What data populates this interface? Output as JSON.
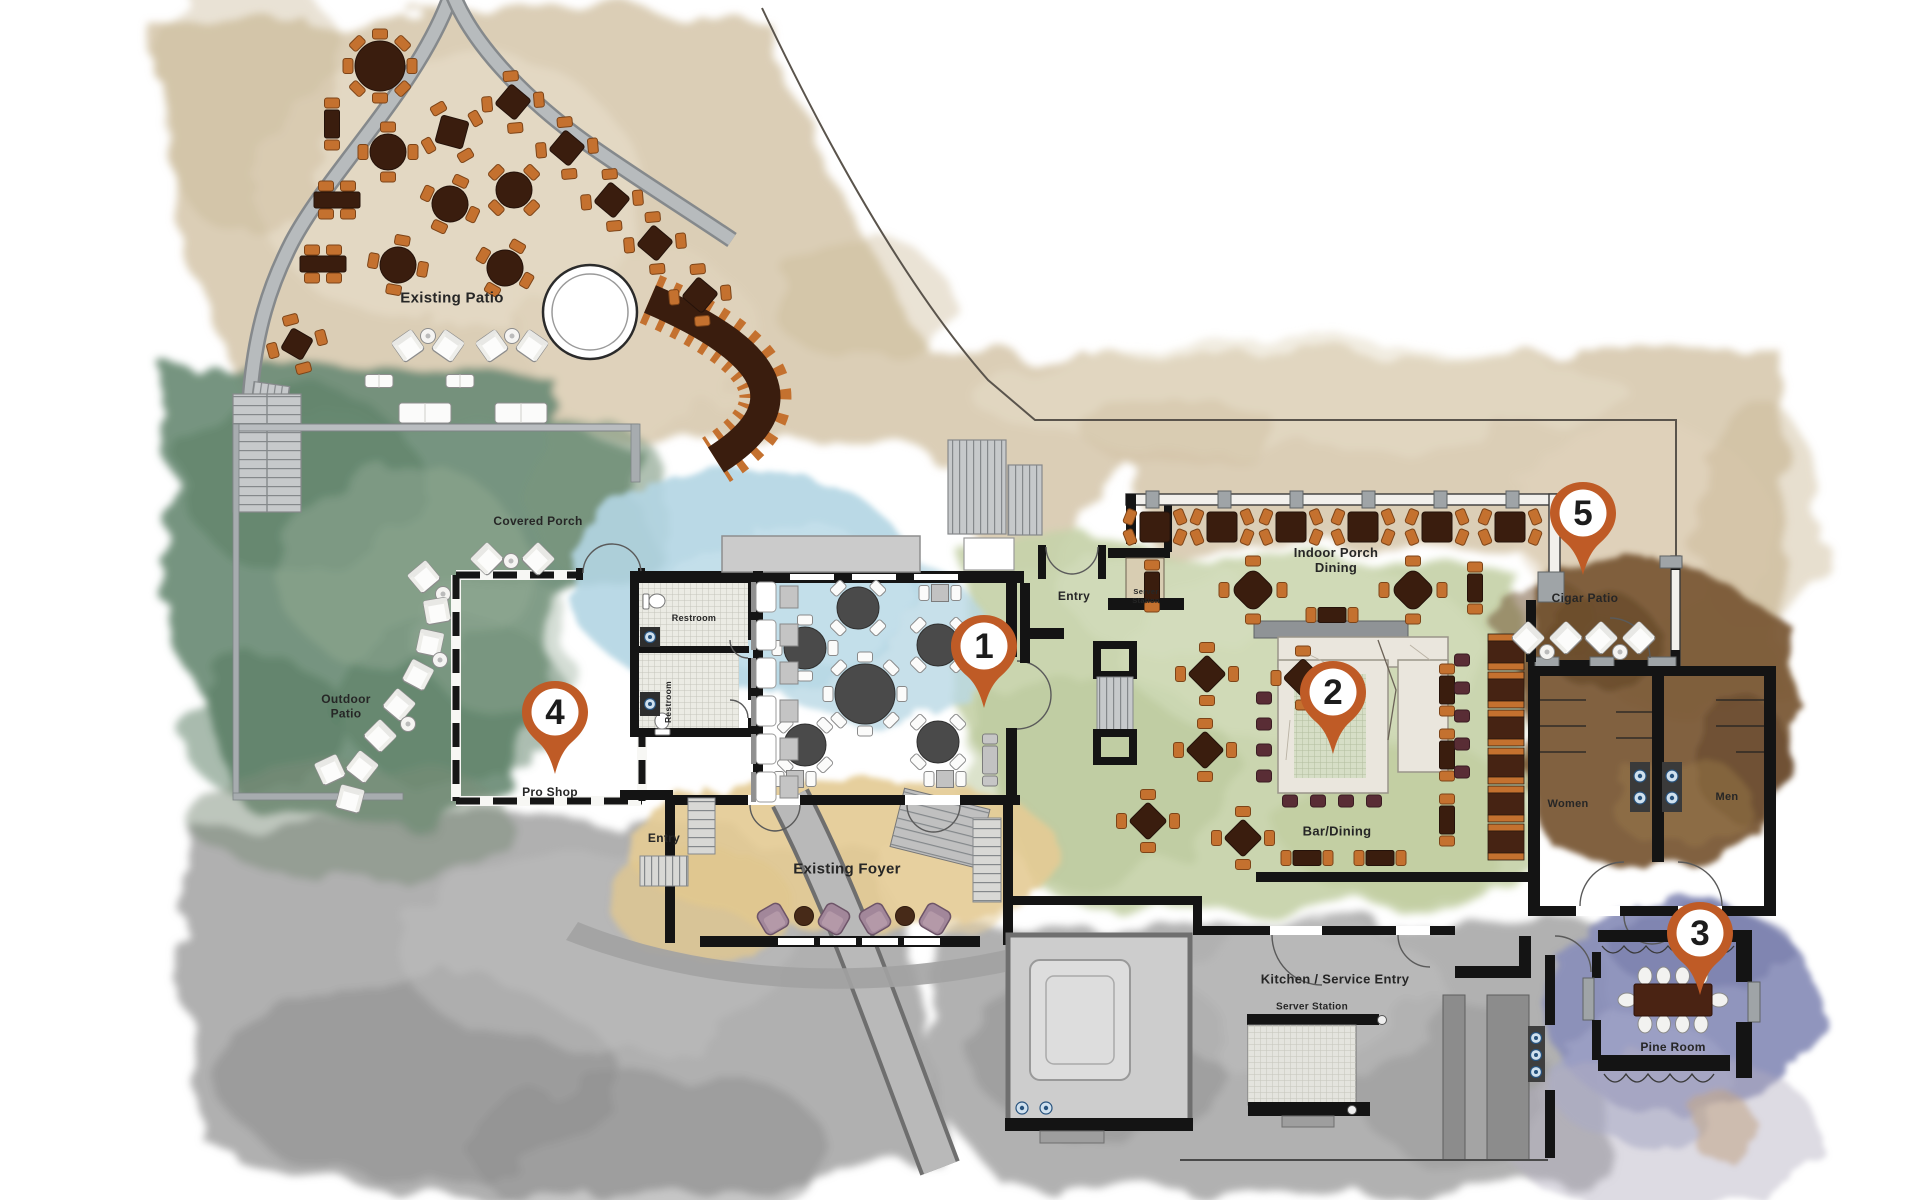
{
  "plan": {
    "title": "Club and restaurant floor plan",
    "colors": {
      "marker": "#bf5b26",
      "marker_number": "#1c1c1c",
      "chair_orange": "#c4712f",
      "table_brown": "#3a1d0e",
      "table_gray": "#4a4a4a",
      "stool_maroon": "#592d35",
      "booth_brown": "#462313",
      "label_text": "#262626"
    },
    "markers": [
      {
        "n": "1",
        "x": 984,
        "y": 646
      },
      {
        "n": "2",
        "x": 1333,
        "y": 692
      },
      {
        "n": "3",
        "x": 1700,
        "y": 933
      },
      {
        "n": "4",
        "x": 555,
        "y": 712
      },
      {
        "n": "5",
        "x": 1583,
        "y": 513
      }
    ],
    "labels": [
      {
        "id": "existing-patio",
        "lines": [
          "Existing Patio"
        ],
        "x": 452,
        "y": 297,
        "size": 15
      },
      {
        "id": "covered-porch",
        "lines": [
          "Covered Porch"
        ],
        "x": 538,
        "y": 521,
        "size": 12
      },
      {
        "id": "outdoor-patio",
        "lines": [
          "Outdoor",
          "Patio"
        ],
        "x": 346,
        "y": 706,
        "size": 12
      },
      {
        "id": "pro-shop",
        "lines": [
          "Pro Shop"
        ],
        "x": 550,
        "y": 792,
        "size": 12
      },
      {
        "id": "restroom-upper",
        "lines": [
          "Restroom"
        ],
        "x": 694,
        "y": 618,
        "size": 9
      },
      {
        "id": "restroom-lower",
        "lines": [
          "Restroom"
        ],
        "x": 668,
        "y": 702,
        "size": 8.5,
        "rot": -90
      },
      {
        "id": "entry-west",
        "lines": [
          "Entry"
        ],
        "x": 664,
        "y": 838,
        "size": 12
      },
      {
        "id": "existing-foyer",
        "lines": [
          "Existing Foyer"
        ],
        "x": 847,
        "y": 868,
        "size": 15
      },
      {
        "id": "entry-main",
        "lines": [
          "Entry"
        ],
        "x": 1074,
        "y": 596,
        "size": 12
      },
      {
        "id": "server-station-top",
        "lines": [
          "Server",
          "Station"
        ],
        "x": 1146,
        "y": 596,
        "size": 7.5
      },
      {
        "id": "indoor-porch-dining",
        "lines": [
          "Indoor Porch",
          "Dining"
        ],
        "x": 1336,
        "y": 560,
        "size": 13
      },
      {
        "id": "bar-dining",
        "lines": [
          "Bar/Dining"
        ],
        "x": 1337,
        "y": 831,
        "size": 13
      },
      {
        "id": "cigar-patio",
        "lines": [
          "Cigar Patio"
        ],
        "x": 1585,
        "y": 598,
        "size": 12
      },
      {
        "id": "women",
        "lines": [
          "Women"
        ],
        "x": 1568,
        "y": 803,
        "size": 11
      },
      {
        "id": "men",
        "lines": [
          "Men"
        ],
        "x": 1727,
        "y": 796,
        "size": 11
      },
      {
        "id": "pine-room",
        "lines": [
          "Pine Room"
        ],
        "x": 1673,
        "y": 1047,
        "size": 12
      },
      {
        "id": "kitchen-service-entry",
        "lines": [
          "Kitchen / Service Entry"
        ],
        "x": 1335,
        "y": 979,
        "size": 13
      },
      {
        "id": "server-station-bottom",
        "lines": [
          "Server Station"
        ],
        "x": 1312,
        "y": 1006,
        "size": 10
      }
    ],
    "furniture": [
      {
        "t": "r8",
        "x": 380,
        "y": 66,
        "s": 25
      },
      {
        "t": "s4d",
        "x": 452,
        "y": 132,
        "s": 28,
        "rot": 15
      },
      {
        "t": "r4",
        "x": 388,
        "y": 152,
        "s": 18
      },
      {
        "t": "r4",
        "x": 450,
        "y": 204,
        "s": 18,
        "rot": 25
      },
      {
        "t": "r4",
        "x": 514,
        "y": 190,
        "s": 18,
        "rot": 45
      },
      {
        "t": "r4",
        "x": 398,
        "y": 265,
        "s": 18,
        "rot": 10
      },
      {
        "t": "r4",
        "x": 505,
        "y": 268,
        "s": 18,
        "rot": 30
      },
      {
        "t": "s4d",
        "x": 513,
        "y": 102,
        "s": 26,
        "rot": 40
      },
      {
        "t": "s4d",
        "x": 567,
        "y": 148,
        "s": 26,
        "rot": 40
      },
      {
        "t": "s4d",
        "x": 612,
        "y": 200,
        "s": 26,
        "rot": 40
      },
      {
        "t": "s4d",
        "x": 655,
        "y": 243,
        "s": 26,
        "rot": 40
      },
      {
        "t": "s4d",
        "x": 700,
        "y": 295,
        "s": 26,
        "rot": 40
      },
      {
        "t": "rect2v",
        "x": 332,
        "y": 124
      },
      {
        "t": "rect4h",
        "x": 337,
        "y": 200
      },
      {
        "t": "rect4h",
        "x": 323,
        "y": 264
      },
      {
        "t": "s4d",
        "x": 297,
        "y": 344,
        "s": 24,
        "rot": 30
      },
      {
        "t": "lounge",
        "x": 408,
        "y": 346,
        "rot": -35
      },
      {
        "t": "sidetable",
        "x": 428,
        "y": 336
      },
      {
        "t": "lounge",
        "x": 448,
        "y": 346,
        "rot": 35
      },
      {
        "t": "lounge",
        "x": 492,
        "y": 346,
        "rot": -35
      },
      {
        "t": "sidetable",
        "x": 512,
        "y": 336
      },
      {
        "t": "lounge",
        "x": 532,
        "y": 346,
        "rot": 35
      },
      {
        "t": "sofa",
        "x": 379,
        "y": 381,
        "w": 28,
        "h": 13
      },
      {
        "t": "sofa",
        "x": 460,
        "y": 381,
        "w": 28,
        "h": 13
      },
      {
        "t": "sofa",
        "x": 425,
        "y": 413,
        "w": 52,
        "h": 20
      },
      {
        "t": "sofa",
        "x": 521,
        "y": 413,
        "w": 52,
        "h": 20
      },
      {
        "t": "lounge",
        "x": 487,
        "y": 559,
        "rot": -45
      },
      {
        "t": "sidetable",
        "x": 511,
        "y": 561
      },
      {
        "t": "lounge",
        "x": 538,
        "y": 559,
        "rot": 45
      },
      {
        "t": "lounge",
        "x": 424,
        "y": 577,
        "rot": -40
      },
      {
        "t": "sidetable",
        "x": 443,
        "y": 594
      },
      {
        "t": "lounge",
        "x": 437,
        "y": 611,
        "rot": -10
      },
      {
        "t": "lounge",
        "x": 430,
        "y": 643,
        "rot": 12
      },
      {
        "t": "sidetable",
        "x": 440,
        "y": 660
      },
      {
        "t": "lounge",
        "x": 418,
        "y": 675,
        "rot": 28
      },
      {
        "t": "lounge",
        "x": 399,
        "y": 705,
        "rot": 40
      },
      {
        "t": "sidetable",
        "x": 408,
        "y": 724
      },
      {
        "t": "lounge",
        "x": 380,
        "y": 736,
        "rot": 45
      },
      {
        "t": "lounge",
        "x": 362,
        "y": 767,
        "rot": 38
      },
      {
        "t": "lounge",
        "x": 350,
        "y": 799,
        "rot": 15
      },
      {
        "t": "lounge",
        "x": 330,
        "y": 770,
        "rot": -25
      },
      {
        "t": "s2h",
        "x": 940,
        "y": 593,
        "p": "w"
      },
      {
        "t": "r4",
        "x": 858,
        "y": 608,
        "s": 21,
        "rot": 45,
        "p": "w"
      },
      {
        "t": "r4",
        "x": 805,
        "y": 648,
        "s": 21,
        "p": "w"
      },
      {
        "t": "r4",
        "x": 938,
        "y": 645,
        "s": 21,
        "rot": 45,
        "p": "w"
      },
      {
        "t": "r8",
        "x": 865,
        "y": 694,
        "s": 30,
        "p": "w"
      },
      {
        "t": "r4",
        "x": 805,
        "y": 745,
        "s": 21,
        "rot": 45,
        "p": "w"
      },
      {
        "t": "r4",
        "x": 938,
        "y": 742,
        "s": 21,
        "rot": 45,
        "p": "w"
      },
      {
        "t": "s2h",
        "x": 795,
        "y": 779,
        "p": "w"
      },
      {
        "t": "s2h",
        "x": 945,
        "y": 779,
        "p": "w"
      },
      {
        "t": "booth",
        "x": 764,
        "y": 597
      },
      {
        "t": "booth",
        "x": 764,
        "y": 635
      },
      {
        "t": "booth",
        "x": 764,
        "y": 673
      },
      {
        "t": "booth",
        "x": 764,
        "y": 711
      },
      {
        "t": "booth",
        "x": 764,
        "y": 749
      },
      {
        "t": "booth",
        "x": 764,
        "y": 787
      },
      {
        "t": "pch",
        "x": 773,
        "y": 919,
        "rot": -30
      },
      {
        "t": "pouf",
        "x": 804,
        "y": 916
      },
      {
        "t": "pch",
        "x": 834,
        "y": 919,
        "rot": 30
      },
      {
        "t": "pch",
        "x": 875,
        "y": 919,
        "rot": -30
      },
      {
        "t": "pouf",
        "x": 905,
        "y": 916
      },
      {
        "t": "pch",
        "x": 935,
        "y": 919,
        "rot": 30
      },
      {
        "t": "s4ew",
        "x": 1155,
        "y": 527,
        "s": 30
      },
      {
        "t": "s4ew",
        "x": 1222,
        "y": 527,
        "s": 30
      },
      {
        "t": "s4ew",
        "x": 1291,
        "y": 527,
        "s": 30
      },
      {
        "t": "s4ew",
        "x": 1363,
        "y": 527,
        "s": 30
      },
      {
        "t": "s4ew",
        "x": 1437,
        "y": 527,
        "s": 30
      },
      {
        "t": "s4ew",
        "x": 1510,
        "y": 527,
        "s": 30
      },
      {
        "t": "rect2v",
        "x": 1152,
        "y": 586
      },
      {
        "t": "s4d",
        "x": 1253,
        "y": 590,
        "s": 32,
        "rx": 9,
        "rot": 45
      },
      {
        "t": "rect2h",
        "x": 1332,
        "y": 615
      },
      {
        "t": "s4d",
        "x": 1413,
        "y": 590,
        "s": 32,
        "rx": 9,
        "rot": 45
      },
      {
        "t": "rect2v",
        "x": 1475,
        "y": 588
      },
      {
        "t": "s4d",
        "x": 1303,
        "y": 678,
        "s": 28,
        "rot": 45
      },
      {
        "t": "s4d",
        "x": 1207,
        "y": 674,
        "s": 27,
        "rot": 45
      },
      {
        "t": "s4d",
        "x": 1205,
        "y": 750,
        "s": 27,
        "rot": 45
      },
      {
        "t": "s4d",
        "x": 1148,
        "y": 821,
        "s": 27,
        "rot": 45
      },
      {
        "t": "s4d",
        "x": 1243,
        "y": 838,
        "s": 27,
        "rot": 45
      },
      {
        "t": "rect2h",
        "x": 1307,
        "y": 858
      },
      {
        "t": "rect2h",
        "x": 1380,
        "y": 858
      },
      {
        "t": "rect2v",
        "x": 1447,
        "y": 690
      },
      {
        "t": "rect2v",
        "x": 1447,
        "y": 755
      },
      {
        "t": "rect2v",
        "x": 1447,
        "y": 820
      },
      {
        "t": "rect2v",
        "x": 990,
        "y": 760,
        "p": "g"
      },
      {
        "t": "stool",
        "x": 1264,
        "y": 698
      },
      {
        "t": "stool",
        "x": 1264,
        "y": 724
      },
      {
        "t": "stool",
        "x": 1264,
        "y": 750
      },
      {
        "t": "stool",
        "x": 1264,
        "y": 776
      },
      {
        "t": "stool",
        "x": 1462,
        "y": 660
      },
      {
        "t": "stool",
        "x": 1462,
        "y": 688
      },
      {
        "t": "stool",
        "x": 1462,
        "y": 716
      },
      {
        "t": "stool",
        "x": 1462,
        "y": 744
      },
      {
        "t": "stool",
        "x": 1462,
        "y": 772
      },
      {
        "t": "stool",
        "x": 1290,
        "y": 801
      },
      {
        "t": "stool",
        "x": 1318,
        "y": 801
      },
      {
        "t": "stool",
        "x": 1346,
        "y": 801
      },
      {
        "t": "stool",
        "x": 1374,
        "y": 801
      },
      {
        "t": "lounge",
        "x": 1528,
        "y": 638,
        "rot": 45
      },
      {
        "t": "sidetable",
        "x": 1547,
        "y": 652
      },
      {
        "t": "lounge",
        "x": 1566,
        "y": 638,
        "rot": -45
      },
      {
        "t": "lounge",
        "x": 1601,
        "y": 638,
        "rot": 45
      },
      {
        "t": "sidetable",
        "x": 1620,
        "y": 652
      },
      {
        "t": "lounge",
        "x": 1639,
        "y": 638,
        "rot": -45
      },
      {
        "t": "conf",
        "x": 1673,
        "y": 1000
      }
    ]
  }
}
